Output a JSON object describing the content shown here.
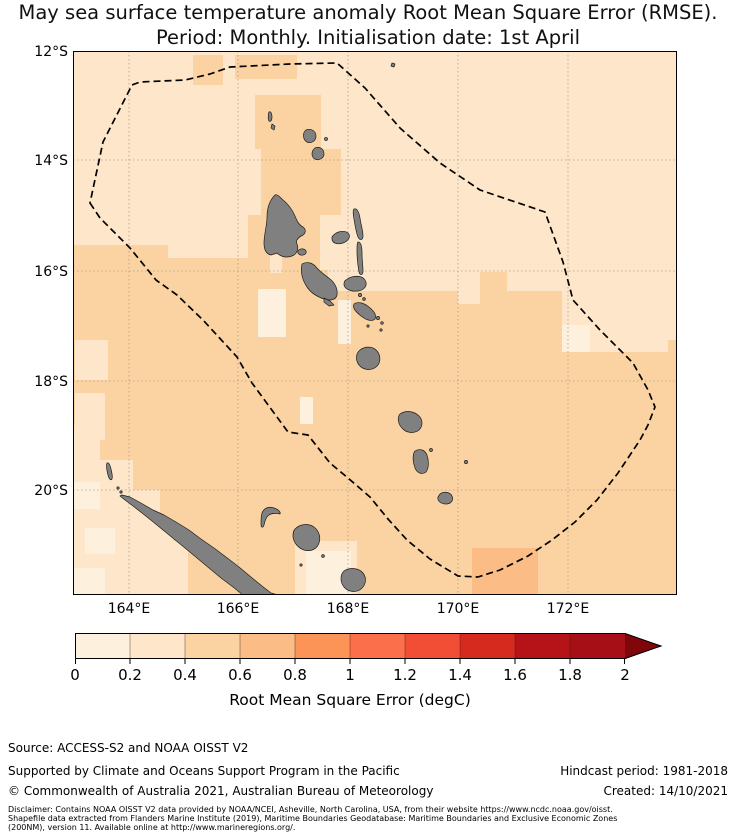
{
  "title": {
    "line1": "May sea surface temperature anomaly Root Mean Square Error (RMSE).",
    "line2": "Period: Monthly. Initialisation date: 1st April"
  },
  "palette": {
    "bins": [
      "#fdf1de",
      "#fde6c9",
      "#fbd3a2",
      "#fbbd85",
      "#fc9357",
      "#fb6f4a",
      "#f24e36",
      "#d52a1d",
      "#b51318",
      "#a50f15"
    ],
    "over": "#7f060b",
    "island": "#808080",
    "island_outline": "#1c1c1c",
    "grid": "#9a9a9a",
    "eez": "#000000",
    "frame": "#000000"
  },
  "map": {
    "lat_ticks": [
      "12°S",
      "14°S",
      "16°S",
      "18°S",
      "20°S"
    ],
    "lon_ticks": [
      "164°E",
      "166°E",
      "168°E",
      "170°E",
      "172°E"
    ]
  },
  "colorbar": {
    "ticks": [
      "0",
      "0.2",
      "0.4",
      "0.6",
      "0.8",
      "1",
      "1.2",
      "1.4",
      "1.6",
      "1.8",
      "2"
    ],
    "label": "Root Mean Square Error (degC)"
  },
  "footer": {
    "source": "Source: ACCESS-S2 and NOAA OISST V2",
    "supported": "Supported by Climate and Oceans Support Program in the Pacific",
    "copyright": "© Commonwealth of Australia 2021, Australian Bureau of Meteorology",
    "hindcast": "Hindcast period: 1981-2018",
    "created": "Created: 14/10/2021",
    "disclaimer": [
      "Disclaimer: Contains NOAA OISST V2 data provided by NOAA/NCEI, Asheville, North Carolina, USA, from their website https://www.ncdc.noaa.gov/oisst.",
      "Shapefile data extracted from Flanders Marine Institute (2019), Maritime Boundaries Geodatabase: Maritime Boundaries and Exclusive Economic Zones",
      "(200NM), version 11. Available online at http://www.marineregions.org/."
    ]
  },
  "chart_data": {
    "type": "heatmap",
    "title": "May sea surface temperature anomaly Root Mean Square Error (RMSE).",
    "subtitle": "Period: Monthly. Initialisation date: 1st April",
    "xlabel": "",
    "ylabel": "",
    "x_ticks": [
      "164°E",
      "166°E",
      "168°E",
      "170°E",
      "172°E"
    ],
    "y_ticks": [
      "12°S",
      "14°S",
      "16°S",
      "18°S",
      "20°S"
    ],
    "lon_range_east": [
      163,
      174
    ],
    "lat_range_south": [
      12,
      22
    ],
    "grid": true,
    "colorbar": {
      "label": "Root Mean Square Error (degC)",
      "ticks": [
        0,
        0.2,
        0.4,
        0.6,
        0.8,
        1,
        1.2,
        1.4,
        1.6,
        1.8,
        2
      ],
      "range": [
        0,
        2
      ],
      "n_bins": 10,
      "extend": "max",
      "orientation": "horizontal-bottom"
    },
    "values_summary": {
      "north_and_east_of_domain": "0.2-0.4 degC",
      "south_west_of_domain_around_New_Caledonia": "0.4-0.6 degC",
      "scattered_cells_near_18S_and_lower_left": "0.0-0.2 degC",
      "small_patch_south_of_New_Caledonia_near_169E": "0.6-0.8 degC"
    },
    "overlays": [
      "dashed EEZ boundary polygon",
      "grey land: Vanuatu island chain, New Caledonia (Grande Terre), Loyalty Islands"
    ]
  }
}
